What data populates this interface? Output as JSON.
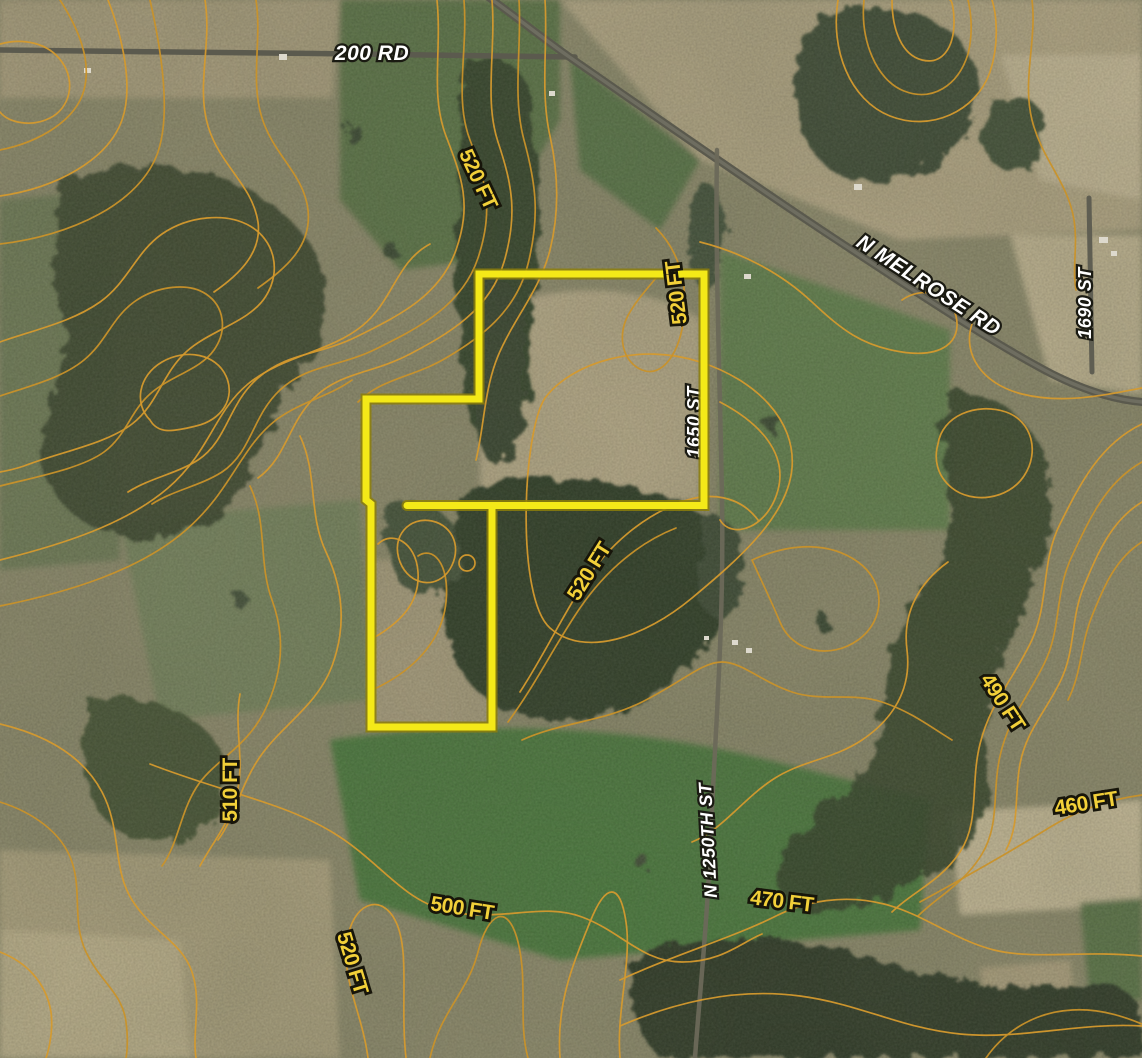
{
  "map": {
    "type": "satellite-topographic-parcel-map",
    "road_labels": [
      {
        "text": "200 RD",
        "orientation": "horizontal"
      },
      {
        "text": "N MELROSE RD",
        "orientation": "diagonal"
      },
      {
        "text": "1690 ST",
        "orientation": "vertical"
      },
      {
        "text": "1650 ST",
        "orientation": "vertical",
        "note": "partially hidden behind parcel boundary line"
      },
      {
        "text": "N 1250TH ST",
        "orientation": "vertical"
      }
    ],
    "contour_labels": [
      {
        "text": "520 FT",
        "elevation_ft": 520,
        "location": "upper-left"
      },
      {
        "text": "520 FT",
        "elevation_ft": 520,
        "location": "parcel-northeast"
      },
      {
        "text": "520 FT",
        "elevation_ft": 520,
        "location": "center"
      },
      {
        "text": "510 FT",
        "elevation_ft": 510,
        "location": "west"
      },
      {
        "text": "520 FT",
        "elevation_ft": 520,
        "location": "southwest"
      },
      {
        "text": "500 FT",
        "elevation_ft": 500,
        "location": "south-center"
      },
      {
        "text": "470 FT",
        "elevation_ft": 470,
        "location": "south"
      },
      {
        "text": "460 FT",
        "elevation_ft": 460,
        "location": "southeast"
      },
      {
        "text": "490 FT",
        "elevation_ft": 490,
        "location": "east"
      }
    ],
    "colors": {
      "parcel_boundary": "#f4e918",
      "contour_line": "#d59a2e",
      "contour_label_fill": "#f2d039",
      "road_label_fill": "#ffffff"
    }
  }
}
